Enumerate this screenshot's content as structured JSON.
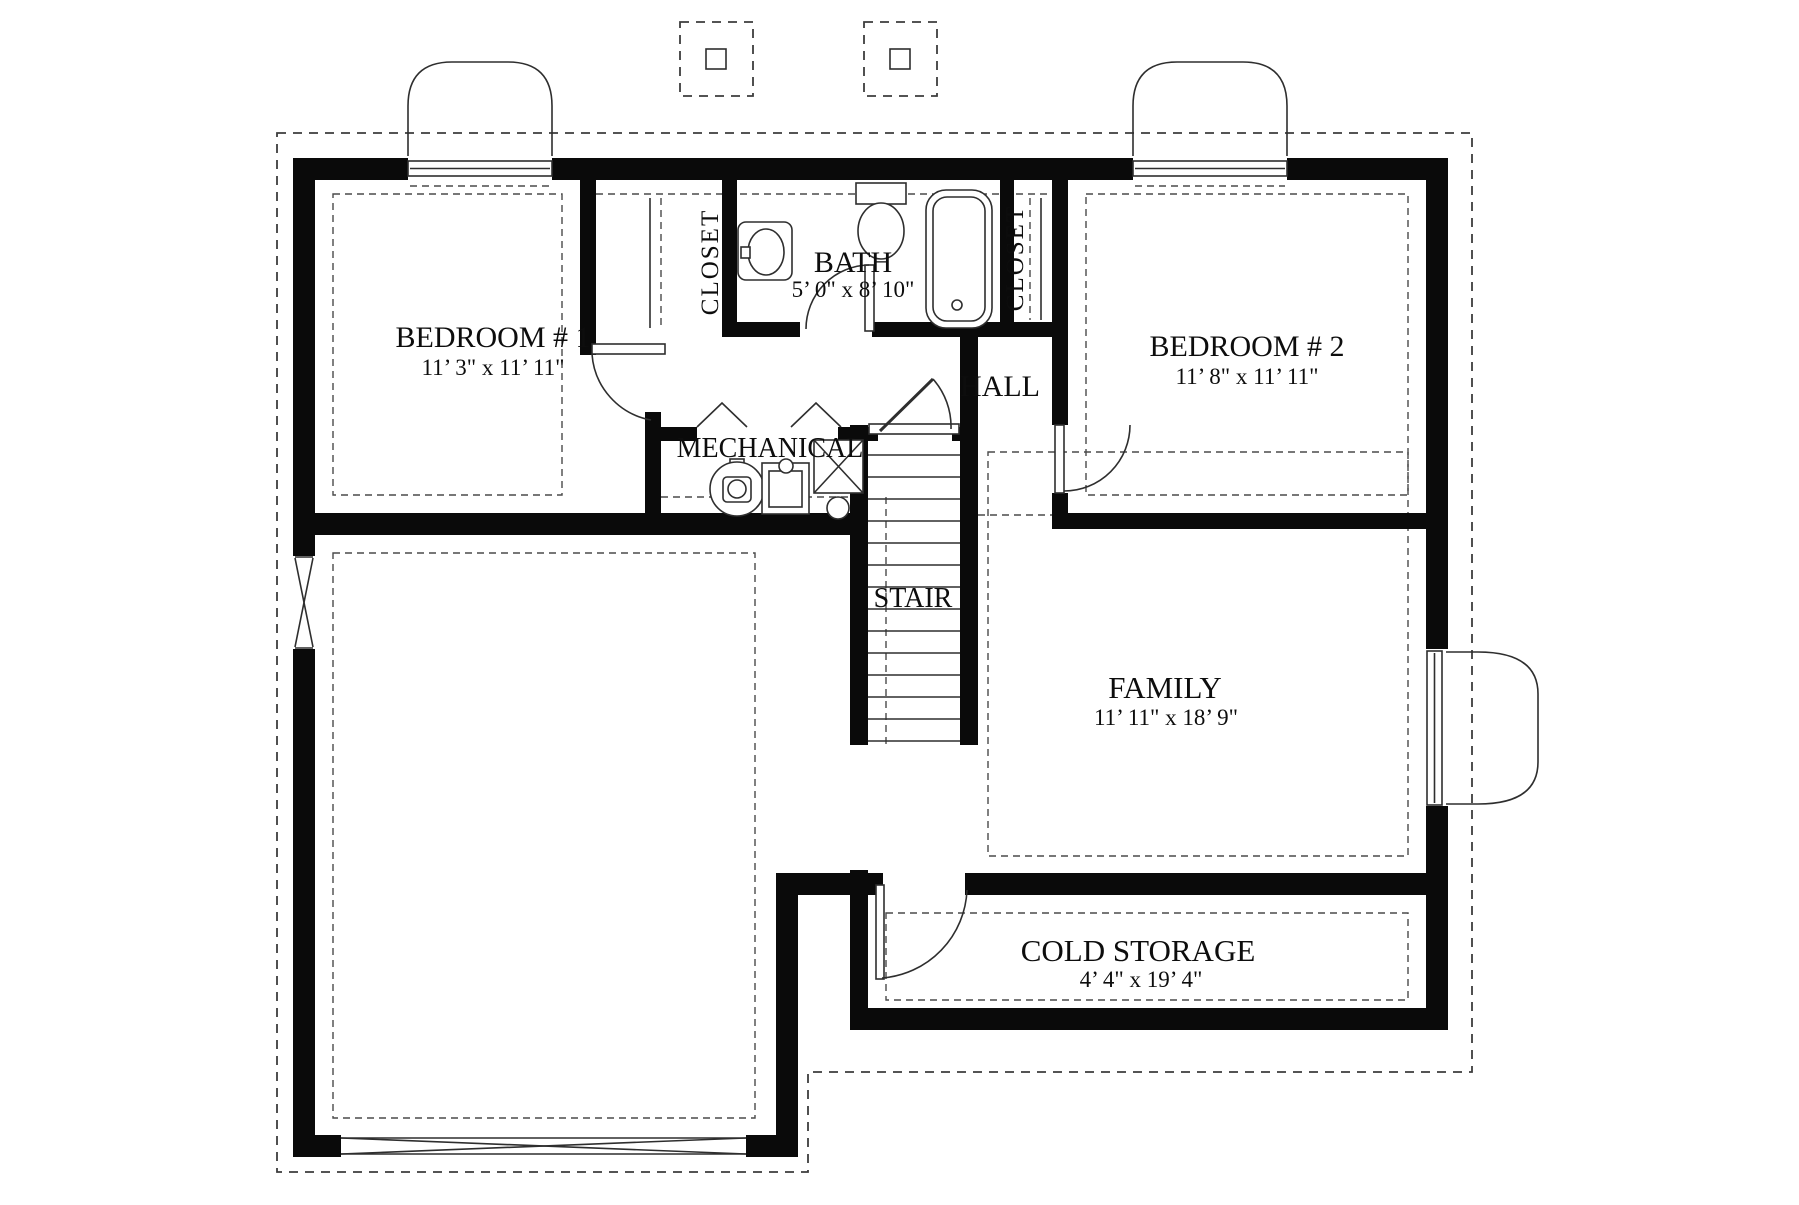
{
  "drawing": {
    "kind": "basement floor plan"
  },
  "colors": {
    "background": "#ffffff",
    "wall_ink": "#0a0a0a",
    "line": "#2e2e2e",
    "dashed_line": "#3d3d3d"
  },
  "labels": {
    "bedroom1": {
      "name": "BEDROOM # 1",
      "dims": "11’ 3\" x 11’ 11\""
    },
    "bedroom2": {
      "name": "BEDROOM # 2",
      "dims": "11’ 8\" x 11’ 11\""
    },
    "bath": {
      "name": "BATH",
      "dims": "5’ 0\" x 8’ 10\""
    },
    "family": {
      "name": "FAMILY",
      "dims": "11’ 11\" x 18’ 9\""
    },
    "cold_storage": {
      "name": "COLD STORAGE",
      "dims": "4’ 4\" x 19’ 4\""
    },
    "hall": {
      "name": "HALL"
    },
    "mechanical": {
      "name": "MECHANICAL"
    },
    "stair": {
      "name": "STAIR"
    },
    "closet_left": {
      "name": "CLOSET"
    },
    "closet_right": {
      "name": "CLOSET"
    }
  },
  "fixtures": [
    "toilet",
    "bathtub",
    "sink",
    "water-heater",
    "furnace",
    "floor-drain",
    "sump",
    "stairs",
    "door-swings",
    "bifold-doors",
    "windows",
    "window-wells",
    "post-footings",
    "closet-rods",
    "garage-door-opening"
  ]
}
